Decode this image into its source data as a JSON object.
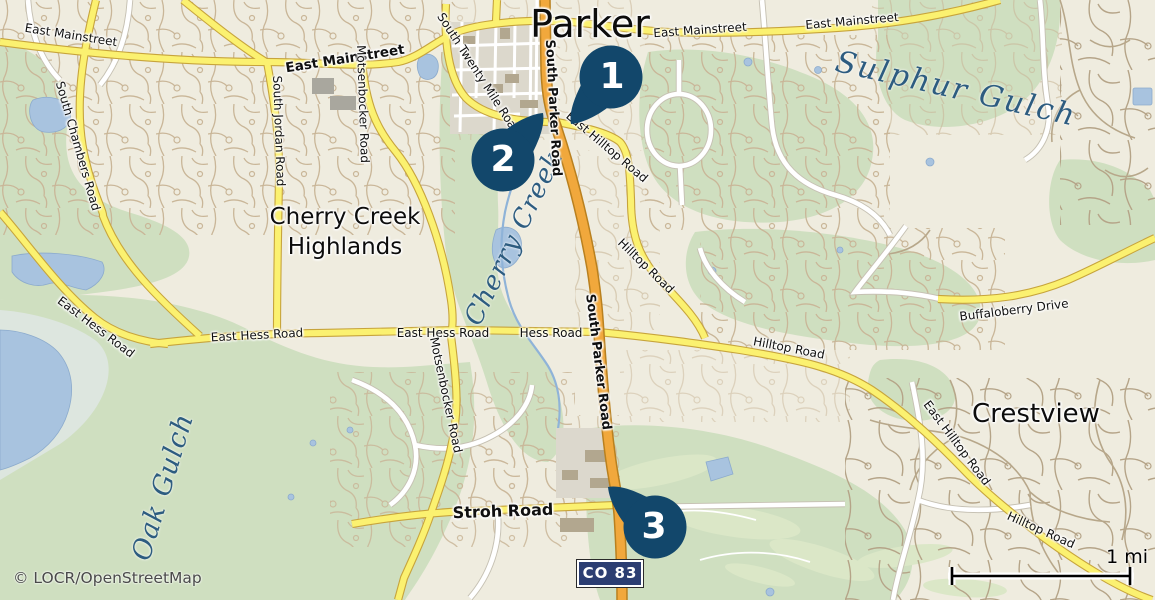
{
  "attribution": "© LOCR/OpenStreetMap",
  "scale_bar": {
    "label": "1 mi"
  },
  "highway_badge": {
    "label": "CO 83"
  },
  "markers": [
    {
      "number": "1"
    },
    {
      "number": "2"
    },
    {
      "number": "3"
    }
  ],
  "map": {
    "city_label": "Parker",
    "area_labels": {
      "cherry_creek_highlands": "Cherry Creek Highlands",
      "crestview": "Crestview"
    },
    "water_labels": {
      "sulphur_gulch": "Sulphur Gulch",
      "cherry_creek": "Cherry Creek",
      "oak_gulch": "Oak Gulch"
    },
    "road_labels": [
      "East Mainstreet",
      "East Mainstreet",
      "East Mainstreet",
      "East Mainstreet",
      "South Parker Road",
      "South Parker Road",
      "East Hilltop Road",
      "Hilltop Road",
      "Hilltop Road",
      "Buffaloberry Drive",
      "East Hilltop Road",
      "Hilltop Road",
      "East Hess Road",
      "East Hess Road",
      "East Hess Road",
      "Hess Road",
      "South Twenty Mile Road",
      "Motsenbocker Road",
      "Motsenbocker Road",
      "South Jordan Road",
      "South Chambers Road",
      "Stroh Road"
    ]
  },
  "colors": {
    "marker": "#12476b",
    "badge_bg": "#2c3e72",
    "road_yellow": "#fbf170",
    "road_orange": "#f1a83c",
    "water": "#a8c3df",
    "green": "#cfdfc0"
  }
}
